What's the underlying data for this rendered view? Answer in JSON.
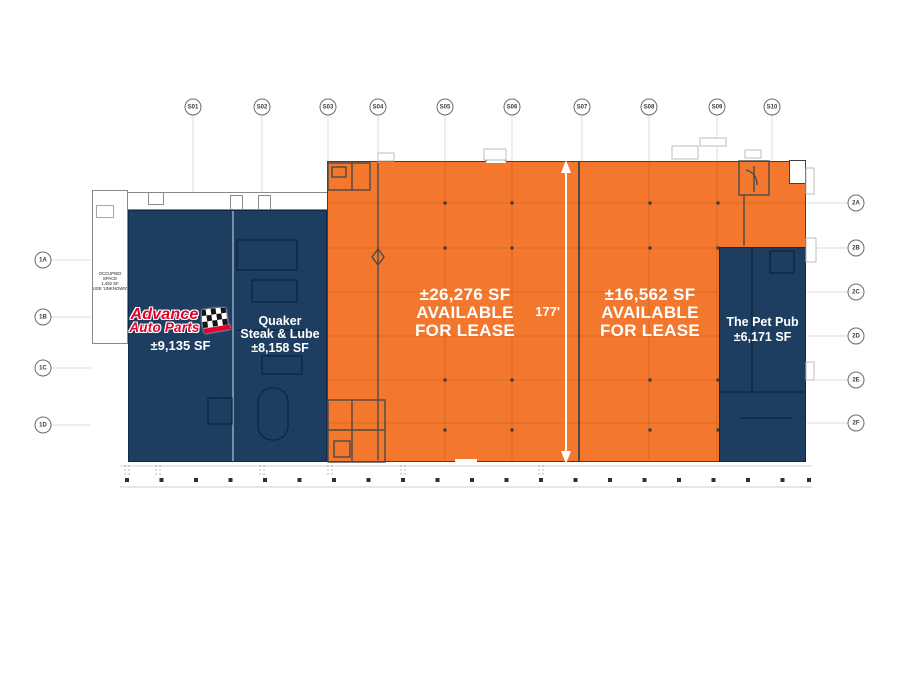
{
  "grid_markers": {
    "top": [
      "S01",
      "S02",
      "S03",
      "S04",
      "S05",
      "S06",
      "S07",
      "S08",
      "S09",
      "S10"
    ],
    "left": [
      "1A",
      "1B",
      "1C",
      "1D"
    ],
    "right": [
      "2A",
      "2B",
      "2C",
      "2D",
      "2E",
      "2F"
    ]
  },
  "annex_note": {
    "line1": "OCCUPIED SPACE",
    "line2": "1,492 SF",
    "line3": "USE 'UNKNOWN'"
  },
  "tenants": {
    "advance": {
      "brand_line1": "Advance",
      "brand_line2": "Auto Parts",
      "area": "±9,135 SF"
    },
    "quaker": {
      "name_line1": "Quaker",
      "name_line2": "Steak & Lube",
      "area": "±8,158 SF"
    },
    "suite_a": {
      "area_line": "±26,276 SF",
      "avail_line1": "AVAILABLE",
      "avail_line2": "FOR LEASE"
    },
    "suite_b": {
      "area_line": "±16,562 SF",
      "avail_line1": "AVAILABLE",
      "avail_line2": "FOR LEASE"
    },
    "pet_pub": {
      "name": "The Pet Pub",
      "area": "±6,171 SF"
    }
  },
  "dimension": {
    "depth_label": "177'"
  },
  "colors": {
    "navy": "#1d3e60",
    "orange": "#f3782e",
    "brand_red": "#e4002b"
  }
}
